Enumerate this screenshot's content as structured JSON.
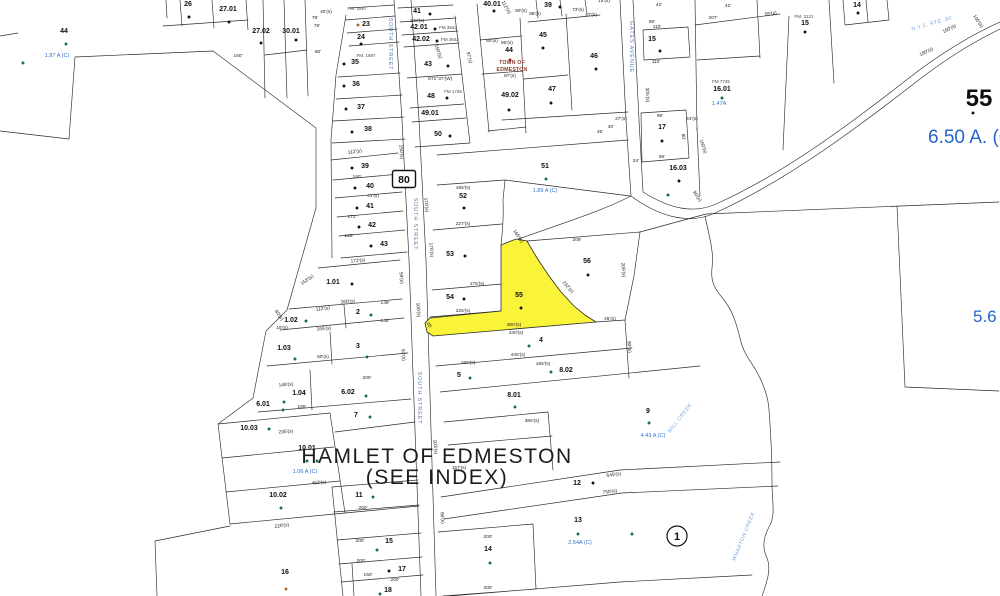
{
  "map": {
    "hamlet_title": "HAMLET OF EDMESTON",
    "hamlet_subtitle": "(SEE INDEX)",
    "route_shield": "80",
    "block_circle_number": "1",
    "town_overlay": {
      "line1": "TOWN OF",
      "line2": "EDMESTON"
    },
    "large_parcel": {
      "number": "55",
      "acreage": "6.50 A. (C)"
    },
    "right_acreage_partial": "5.6",
    "highlighted_parcel": {
      "number": "55",
      "color": "#f9f33a"
    },
    "colors": {
      "line": "#2b2b2b",
      "parcel_text": "#101010",
      "blue": "#2e6fce",
      "road_blue": "#5a7fae",
      "creek_blue": "#7aa6d9",
      "town_red": "#8d3a2f",
      "highlight": "#f9f33a",
      "k": "#111111",
      "t": "#0e6b5c",
      "r": "#8d2f23",
      "o": "#b06820"
    },
    "parcel_labels": [
      [
        "44",
        64,
        33
      ],
      [
        "26",
        188,
        6
      ],
      [
        "27.01",
        228,
        11
      ],
      [
        "27.02",
        261,
        33
      ],
      [
        "30.01",
        291,
        33
      ],
      [
        "23",
        366,
        26
      ],
      [
        "24",
        361,
        39
      ],
      [
        "35",
        355,
        64
      ],
      [
        "36",
        356,
        86
      ],
      [
        "37",
        361,
        109
      ],
      [
        "38",
        368,
        131
      ],
      [
        "39",
        365,
        168
      ],
      [
        "40",
        370,
        188
      ],
      [
        "41",
        370,
        208
      ],
      [
        "42",
        372,
        227
      ],
      [
        "43",
        384,
        246
      ],
      [
        "41",
        417,
        13
      ],
      [
        "42.01",
        419,
        29
      ],
      [
        "42.02",
        421,
        41
      ],
      [
        "43",
        428,
        66
      ],
      [
        "48",
        431,
        98
      ],
      [
        "49.01",
        430,
        115
      ],
      [
        "50",
        438,
        136
      ],
      [
        "40.01",
        492,
        6
      ],
      [
        "44",
        509,
        52
      ],
      [
        "49.02",
        510,
        97
      ],
      [
        "39",
        548,
        7
      ],
      [
        "45",
        543,
        37
      ],
      [
        "46",
        594,
        58
      ],
      [
        "47",
        552,
        91
      ],
      [
        "52",
        463,
        198
      ],
      [
        "53",
        450,
        256
      ],
      [
        "54",
        450,
        299
      ],
      [
        "55",
        519,
        297
      ],
      [
        "56",
        587,
        263
      ],
      [
        "51",
        545,
        168
      ],
      [
        "15",
        652,
        41
      ],
      [
        "17",
        662,
        129
      ],
      [
        "16.03",
        678,
        170
      ],
      [
        "14",
        857,
        7
      ],
      [
        "15",
        805,
        25
      ],
      [
        "16.01",
        722,
        91
      ],
      [
        "1.01",
        333,
        284
      ],
      [
        "2",
        358,
        314
      ],
      [
        "3",
        358,
        348
      ],
      [
        "1.02",
        291,
        322
      ],
      [
        "1.03",
        284,
        350
      ],
      [
        "1.04",
        299,
        395
      ],
      [
        "6.01",
        263,
        406
      ],
      [
        "6.02",
        348,
        394
      ],
      [
        "7",
        356,
        417
      ],
      [
        "10.03",
        249,
        430
      ],
      [
        "10.01",
        307,
        450
      ],
      [
        "10.02",
        278,
        497
      ],
      [
        "16",
        285,
        574
      ],
      [
        "11",
        359,
        497
      ],
      [
        "15",
        389,
        543
      ],
      [
        "17",
        402,
        571
      ],
      [
        "18",
        388,
        592
      ],
      [
        "4",
        541,
        342
      ],
      [
        "5",
        459,
        377
      ],
      [
        "8.02",
        566,
        372
      ],
      [
        "8.01",
        514,
        397
      ],
      [
        "9",
        648,
        413
      ],
      [
        "12",
        577,
        485
      ],
      [
        "13",
        578,
        522
      ],
      [
        "14",
        488,
        551
      ]
    ],
    "dimension_labels": [
      [
        "160'",
        238,
        57,
        0
      ],
      [
        "80'",
        318,
        53,
        0
      ],
      [
        "40'(s)",
        326,
        13,
        0
      ],
      [
        "78'",
        315,
        19,
        0
      ],
      [
        "76'",
        317,
        27,
        0
      ],
      [
        "140'(s)",
        417,
        22,
        0
      ],
      [
        "150'(s)",
        437,
        52,
        70
      ],
      [
        "112'(s)",
        355,
        153,
        -8
      ],
      [
        "160'",
        357,
        178,
        0
      ],
      [
        "41'(s)",
        373,
        197,
        0
      ],
      [
        "172'",
        352,
        218,
        0
      ],
      [
        "125'",
        349,
        237,
        0
      ],
      [
        "112'(s)",
        505,
        8,
        60
      ],
      [
        "95'(s)",
        535,
        15,
        0
      ],
      [
        "90'(s)",
        521,
        12,
        0
      ],
      [
        "73'(s)",
        578,
        11,
        0
      ],
      [
        "47'(s)",
        591,
        16,
        0
      ],
      [
        "15'(s)",
        604,
        2,
        0
      ],
      [
        "80'(s)",
        492,
        42,
        0
      ],
      [
        "85'(s)",
        507,
        44,
        0
      ],
      [
        "87'(s)",
        510,
        77,
        0
      ],
      [
        "S71°37'(W)",
        440,
        80,
        0
      ],
      [
        "97'(s)",
        468,
        58,
        75
      ],
      [
        "42'",
        728,
        7,
        0
      ],
      [
        "207'",
        713,
        19,
        0
      ],
      [
        "55'(s)",
        771,
        15,
        -10
      ],
      [
        "80'",
        652,
        23,
        0
      ],
      [
        "110'",
        657,
        28,
        0
      ],
      [
        "110'",
        656,
        63,
        0
      ],
      [
        "42'",
        659,
        6,
        0
      ],
      [
        "105'(s)",
        977,
        22,
        55
      ],
      [
        "160'(s)",
        950,
        30,
        -27
      ],
      [
        "180'(s)",
        927,
        53,
        -25
      ],
      [
        "170'(s)",
        425,
        205,
        85
      ],
      [
        "170'(s)",
        430,
        250,
        85
      ],
      [
        "150'(s)",
        400,
        152,
        85
      ],
      [
        "100'(s)",
        417,
        310,
        85
      ],
      [
        "103'(s)",
        434,
        447,
        85
      ],
      [
        "90'(s)",
        441,
        518,
        85
      ],
      [
        "305'(s)",
        646,
        95,
        88
      ],
      [
        "27'(s)",
        621,
        120,
        0
      ],
      [
        "40'",
        611,
        128,
        0
      ],
      [
        "45'",
        600,
        133,
        0
      ],
      [
        "24'",
        636,
        162,
        0
      ],
      [
        "96'",
        660,
        117,
        0
      ],
      [
        "96'",
        662,
        158,
        0
      ],
      [
        "80'",
        682,
        137,
        85
      ],
      [
        "44'(s)",
        692,
        120,
        0
      ],
      [
        "160'(s)",
        702,
        147,
        70
      ],
      [
        "90'(s)",
        696,
        197,
        55
      ],
      [
        "195'(s)",
        463,
        189,
        0
      ],
      [
        "227'(s)",
        463,
        225,
        0
      ],
      [
        "175'(s)",
        477,
        285,
        0
      ],
      [
        "225'(s)",
        463,
        312,
        0
      ],
      [
        "209'",
        577,
        241,
        0
      ],
      [
        "165'(s)",
        517,
        237,
        55
      ],
      [
        "232'(s)",
        567,
        288,
        48
      ],
      [
        "360'(s)",
        514,
        326,
        0
      ],
      [
        "440'(s)",
        516,
        334,
        0
      ],
      [
        "45'(s)",
        610,
        320,
        0
      ],
      [
        "45'",
        428,
        326,
        55
      ],
      [
        "205'(s)",
        622,
        270,
        85
      ],
      [
        "185'(s)",
        543,
        365,
        0
      ],
      [
        "180'(s)",
        468,
        364,
        0
      ],
      [
        "445'(s)",
        518,
        356,
        0
      ],
      [
        "365'(s)",
        532,
        422,
        0
      ],
      [
        "90'(s)",
        628,
        347,
        85
      ],
      [
        "172'(s)",
        358,
        262,
        -5
      ],
      [
        "260'(s)",
        348,
        303,
        -5
      ],
      [
        "148'",
        385,
        304,
        0
      ],
      [
        "148'",
        385,
        322,
        0
      ],
      [
        "112'(s)",
        323,
        310,
        -8
      ],
      [
        "153'(s)",
        308,
        281,
        -35
      ],
      [
        "165'(s)",
        324,
        330,
        -5
      ],
      [
        "50'(s)",
        323,
        358,
        0
      ],
      [
        "59'(s)",
        400,
        278,
        85
      ],
      [
        "63'(s)",
        402,
        355,
        85
      ],
      [
        "80'(s)",
        278,
        316,
        55
      ],
      [
        "10'(s)",
        282,
        329,
        0
      ],
      [
        "148'(s)",
        286,
        386,
        -5
      ],
      [
        "165'",
        302,
        408,
        0
      ],
      [
        "200'",
        367,
        379,
        0
      ],
      [
        "235'(s)",
        286,
        433,
        -5
      ],
      [
        "452'(s)",
        319,
        484,
        -5
      ],
      [
        "220'(s)",
        282,
        527,
        -8
      ],
      [
        "200'",
        363,
        509,
        0
      ],
      [
        "200'",
        360,
        542,
        0
      ],
      [
        "200'",
        361,
        562,
        0
      ],
      [
        "150'",
        368,
        576,
        0
      ],
      [
        "200'",
        395,
        581,
        0
      ],
      [
        "200'",
        488,
        538,
        0
      ],
      [
        "200'",
        488,
        589,
        0
      ],
      [
        "157'(s)",
        459,
        469,
        0
      ],
      [
        "645'(s)",
        614,
        476,
        -8
      ],
      [
        "750'(s)",
        610,
        493,
        -8
      ]
    ],
    "acreage_labels": [
      [
        "1.87 A (C)",
        57,
        57
      ],
      [
        "1.89 A (C)",
        545,
        192
      ],
      [
        "1.47A",
        719,
        105
      ],
      [
        "1.06 A (C)",
        305,
        473
      ],
      [
        "2.54A (C)",
        580,
        544
      ],
      [
        "4.43 A (C)",
        653,
        437
      ]
    ],
    "plat_labels": [
      [
        "FM. 1697",
        357,
        10
      ],
      [
        "FM. 1697",
        366,
        57
      ],
      [
        "FM 3642",
        448,
        29
      ],
      [
        "FM 3642",
        450,
        41
      ],
      [
        "FM 1726",
        453,
        93
      ],
      [
        "FM. 3121",
        804,
        18
      ],
      [
        "FM 7745",
        721,
        83
      ]
    ],
    "road_labels": [
      [
        "SOUTH STREET",
        389,
        44,
        90
      ],
      [
        "SOUTH STREET",
        414,
        224,
        90
      ],
      [
        "SOUTH STREET",
        418,
        398,
        90
      ],
      [
        "GATES AVENUE",
        630,
        47,
        90
      ]
    ],
    "water_labels": [
      [
        "MILL CREEK",
        681,
        419,
        -52
      ],
      [
        "WHARTON CREEK",
        745,
        537,
        -68
      ],
      [
        "N.Y.S. RTE. 80",
        932,
        25,
        -16
      ]
    ],
    "dots": [
      [
        66,
        44,
        "t"
      ],
      [
        23,
        63,
        "t"
      ],
      [
        189,
        17,
        "k"
      ],
      [
        229,
        22,
        "k"
      ],
      [
        261,
        43,
        "k"
      ],
      [
        296,
        40,
        "k"
      ],
      [
        358,
        25,
        "o"
      ],
      [
        361,
        44,
        "k"
      ],
      [
        344,
        64,
        "k"
      ],
      [
        344,
        86,
        "k"
      ],
      [
        346,
        109,
        "k"
      ],
      [
        352,
        132,
        "k"
      ],
      [
        352,
        168,
        "k"
      ],
      [
        355,
        188,
        "k"
      ],
      [
        357,
        208,
        "k"
      ],
      [
        359,
        227,
        "k"
      ],
      [
        371,
        246,
        "k"
      ],
      [
        430,
        14,
        "k"
      ],
      [
        435,
        29,
        "k"
      ],
      [
        437,
        41,
        "k"
      ],
      [
        448,
        66,
        "k"
      ],
      [
        447,
        98,
        "k"
      ],
      [
        450,
        136,
        "k"
      ],
      [
        494,
        11,
        "k"
      ],
      [
        510,
        60,
        "r"
      ],
      [
        509,
        110,
        "k"
      ],
      [
        560,
        7,
        "k"
      ],
      [
        543,
        48,
        "k"
      ],
      [
        596,
        69,
        "k"
      ],
      [
        551,
        103,
        "k"
      ],
      [
        464,
        208,
        "k"
      ],
      [
        465,
        256,
        "k"
      ],
      [
        464,
        299,
        "k"
      ],
      [
        521,
        308,
        "k"
      ],
      [
        588,
        275,
        "k"
      ],
      [
        546,
        179,
        "t"
      ],
      [
        660,
        51,
        "k"
      ],
      [
        662,
        141,
        "k"
      ],
      [
        679,
        181,
        "k"
      ],
      [
        668,
        195,
        "t"
      ],
      [
        858,
        13,
        "k"
      ],
      [
        805,
        32,
        "k"
      ],
      [
        722,
        98,
        "t"
      ],
      [
        973,
        113,
        "k"
      ],
      [
        352,
        284,
        "k"
      ],
      [
        371,
        315,
        "t"
      ],
      [
        306,
        321,
        "t"
      ],
      [
        295,
        359,
        "t"
      ],
      [
        367,
        357,
        "t"
      ],
      [
        284,
        402,
        "t"
      ],
      [
        366,
        396,
        "t"
      ],
      [
        283,
        410,
        "t"
      ],
      [
        370,
        417,
        "t"
      ],
      [
        269,
        429,
        "t"
      ],
      [
        307,
        461,
        "t"
      ],
      [
        317,
        461,
        "t"
      ],
      [
        281,
        508,
        "t"
      ],
      [
        286,
        589,
        "o"
      ],
      [
        373,
        497,
        "t"
      ],
      [
        377,
        550,
        "t"
      ],
      [
        389,
        571,
        "k"
      ],
      [
        380,
        594,
        "t"
      ],
      [
        529,
        346,
        "t"
      ],
      [
        470,
        378,
        "t"
      ],
      [
        551,
        372,
        "t"
      ],
      [
        515,
        407,
        "t"
      ],
      [
        649,
        423,
        "t"
      ],
      [
        593,
        483,
        "k"
      ],
      [
        578,
        534,
        "t"
      ],
      [
        632,
        534,
        "t"
      ],
      [
        490,
        563,
        "t"
      ]
    ]
  }
}
